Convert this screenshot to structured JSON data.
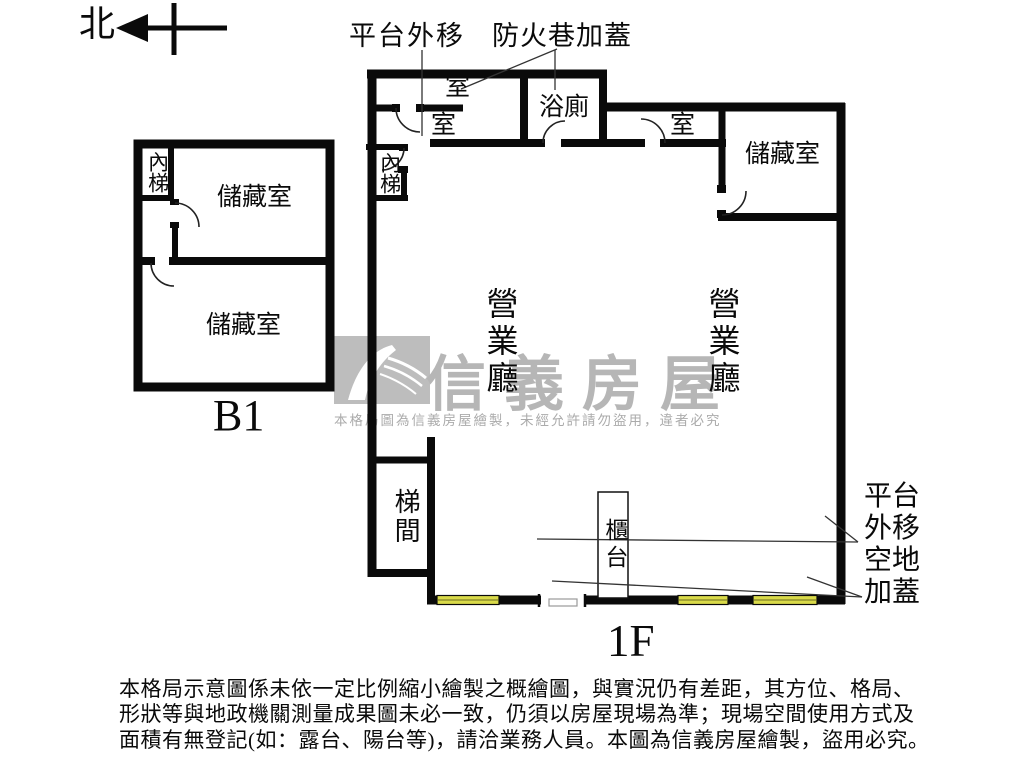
{
  "compass": {
    "north": "北"
  },
  "annotations": {
    "platform_top": "平台外移",
    "fire_lane": "防火巷加蓋",
    "right_note": "平台\n外移\n空地\n加蓋"
  },
  "b1_plan": {
    "floor_label": "B1",
    "inner_stair": "內梯",
    "storage_top": "儲藏室",
    "storage_bottom": "儲藏室"
  },
  "f1_plan": {
    "floor_label": "1F",
    "room_a": "室",
    "room_b": "室",
    "bathroom": "浴廁",
    "room_c": "室",
    "storage": "儲藏室",
    "inner_stair": "內梯",
    "hall_left": "營業廳",
    "hall_right": "營業廳",
    "stairwell": "梯間",
    "counter": "櫃台"
  },
  "watermark": {
    "brand": "信義房屋",
    "notice": "本格局圖為信義房屋繪製，未經允許請勿盜用，違者必究"
  },
  "disclaimer": {
    "line1": "本格局示意圖係未依一定比例縮小繪製之概繪圖，與實況仍有差距，其方位、格局、",
    "line2": "形狀等與地政機關測量成果圖未必一致，仍須以房屋現場為準；現場空間使用方式及",
    "line3": "面積有無登記(如：露台、陽台等)，請洽業務人員。本圖為信義房屋繪製，盜用必究。"
  },
  "colors": {
    "wall": "#0a0a0a",
    "window_fill": "#d9da4a",
    "watermark_gray": "#bdbdbd"
  }
}
